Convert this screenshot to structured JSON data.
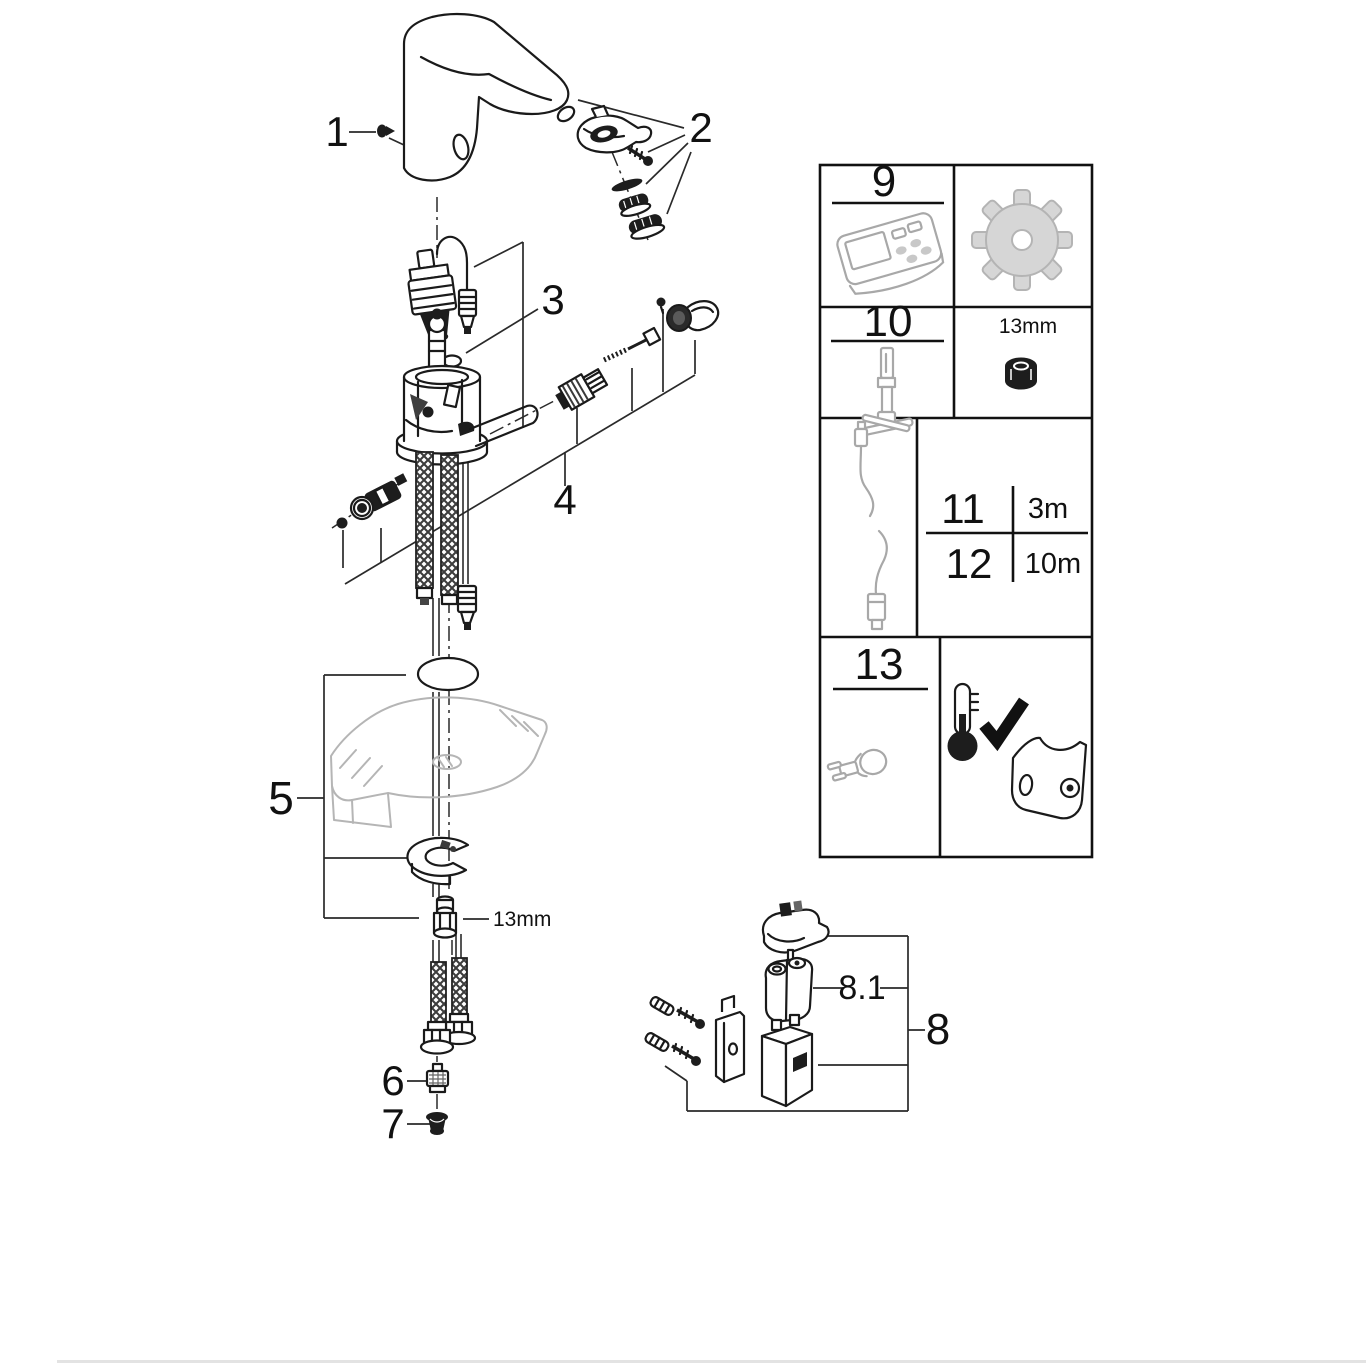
{
  "callouts": {
    "c1": "1",
    "c2": "2",
    "c3": "3",
    "c4": "4",
    "c5": "5",
    "c6": "6",
    "c7": "7",
    "c8": "8",
    "c8_1": "8.1"
  },
  "annotations": {
    "mount_nut_wrench_size": "13mm"
  },
  "panel": {
    "cell9": {
      "number": "9",
      "icon": "remote-control-icon"
    },
    "cell9b": {
      "icon": "gear-icon"
    },
    "cell10": {
      "number": "10",
      "icon": "socket-wrench-icon"
    },
    "cell10b": {
      "wrench_size": "13mm",
      "icon": "hex-nut-icon"
    },
    "cell11_12_left": {
      "icon": "extension-cable-icon"
    },
    "cell11_12": {
      "rows": [
        {
          "number": "11",
          "length": "3m"
        },
        {
          "number": "12",
          "length": "10m"
        }
      ]
    },
    "cell13": {
      "number": "13",
      "icon": "fixing-plug-icon"
    },
    "cell13b": {
      "icons": [
        "thermal-disinfection-check-icon",
        "mounting-plate-icon"
      ]
    }
  }
}
